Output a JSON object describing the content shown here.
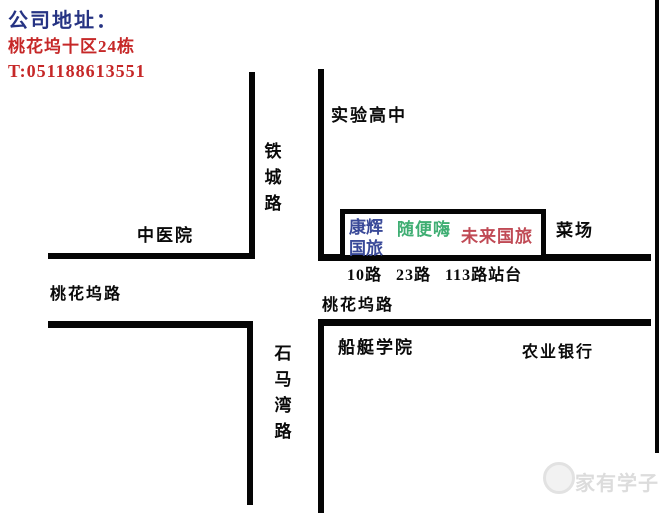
{
  "header": {
    "address_label": "公司地址：",
    "address_value": "桃花坞十区24栋",
    "phone": "T:051188613551"
  },
  "map": {
    "labels": {
      "school": "实验高中",
      "tiecheng_road": "铁城路",
      "hospital": "中医院",
      "taohuawu_road_left": "桃花坞路",
      "taohuawu_road_right": "桃花坞路",
      "bus_stop": "10路 23路 113路站台",
      "market": "菜场",
      "boat_college": "船艇学院",
      "bank": "农业银行",
      "shima_road": "石马湾路"
    },
    "shops": {
      "kanghui_line1": "康辉",
      "kanghui_line2": "国旅",
      "suibianhai": "随便嗨",
      "weilai_guolv": "未来国旅"
    }
  },
  "watermark": {
    "text": "家有学子"
  },
  "colors": {
    "address_label": "#263383",
    "address_value": "#c62828",
    "phone": "#c62828",
    "kanghui": "#3a4a99",
    "suibianhai": "#3fae73",
    "weilai": "#c04a55",
    "road": "#050505"
  }
}
